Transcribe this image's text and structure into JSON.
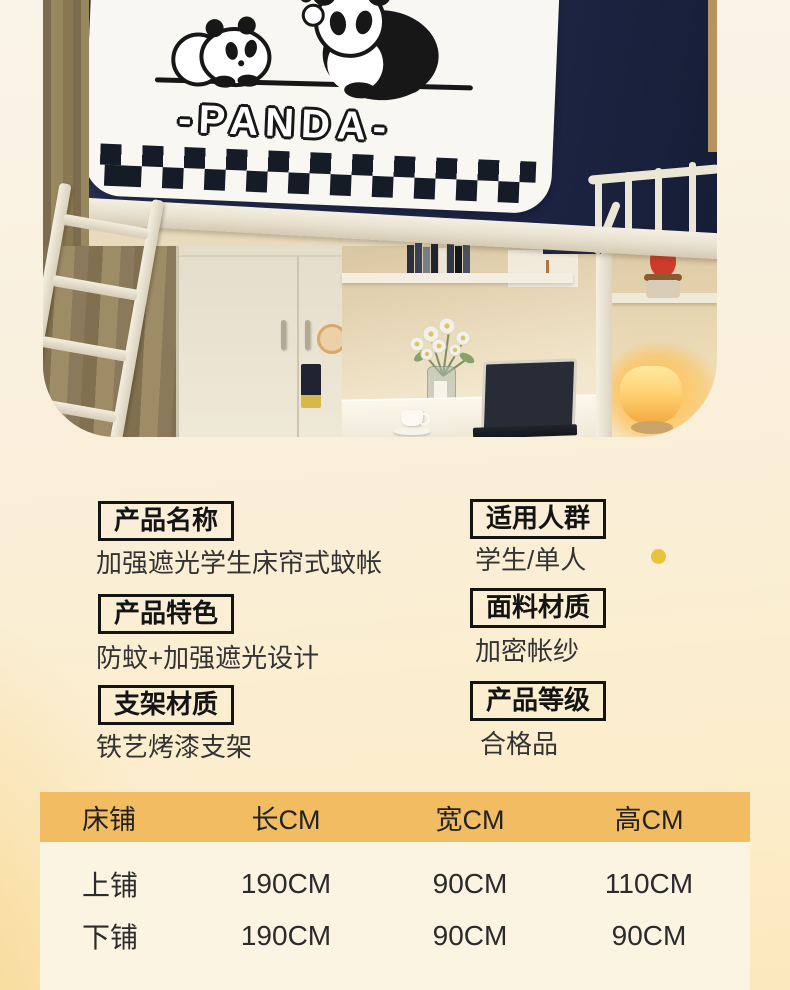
{
  "photo": {
    "panda_text": "-PANDA-",
    "colors": {
      "curtain_navy": "#1f2741",
      "panel_white": "#f8f7f1",
      "window_drape": "#8f7f5f",
      "frame_cream": "#ece6d6",
      "lamp_glow": "#ffce69",
      "red_vase": "#cf3b2b"
    }
  },
  "specs": {
    "left": [
      {
        "label": "产品名称",
        "value": "加强遮光学生床帘式蚊帐"
      },
      {
        "label": "产品特色",
        "value": "防蚊+加强遮光设计"
      },
      {
        "label": "支架材质",
        "value": "铁艺烤漆支架"
      }
    ],
    "right": [
      {
        "label": "适用人群",
        "value": "学生/单人"
      },
      {
        "label": "面料材质",
        "value": "加密帐纱"
      },
      {
        "label": "产品等级",
        "value": "合格品"
      }
    ]
  },
  "size_table": {
    "header_bg": "#f2bc63",
    "columns": [
      "床铺",
      "长CM",
      "宽CM",
      "高CM"
    ],
    "rows": [
      [
        "上铺",
        "190CM",
        "90CM",
        "110CM"
      ],
      [
        "下铺",
        "190CM",
        "90CM",
        "90CM"
      ]
    ]
  },
  "chart_data": {
    "type": "table",
    "columns": [
      "床铺",
      "长CM",
      "宽CM",
      "高CM"
    ],
    "rows": [
      [
        "上铺",
        "190CM",
        "90CM",
        "110CM"
      ],
      [
        "下铺",
        "190CM",
        "90CM",
        "90CM"
      ]
    ],
    "title": "床帘尺寸表"
  }
}
